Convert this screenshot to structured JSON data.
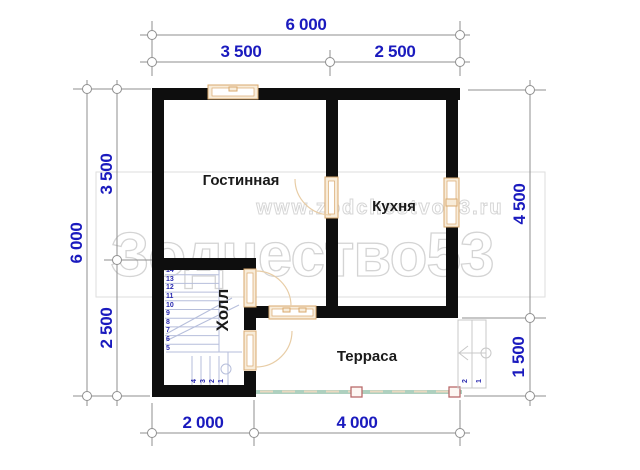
{
  "plan": {
    "watermark": {
      "site": "www.zodchestvo53.ru",
      "brand": "Зодчество53"
    },
    "rooms": {
      "living_room": "Гостинная",
      "kitchen": "Кухня",
      "hall": "Холл",
      "terrace": "Терраса"
    },
    "dims": {
      "top_total": "6 000",
      "top_left": "3 500",
      "top_right": "2 500",
      "left_total": "6 000",
      "left_top": "3 500",
      "left_bottom": "2 500",
      "right_top": "4 500",
      "right_bottom": "1 500",
      "bottom_left": "2 000",
      "bottom_right": "4 000"
    },
    "stairs": {
      "upper": [
        "14",
        "13",
        "12",
        "11",
        "10",
        "9",
        "8",
        "7",
        "6",
        "5"
      ],
      "lower": [
        "4",
        "3",
        "2",
        "1"
      ]
    },
    "terrace_steps": [
      "2",
      "1"
    ],
    "colors": {
      "dimension_text": "#1a1abe",
      "dimension_line": "#8f8f8f",
      "wall": "#0e0e0e",
      "joinery_frame": "#d9a96e",
      "joinery_fill": "#f8ecd9",
      "door_arc": "#e8cda6",
      "deck_edge": "#aed0bf",
      "deck_post": "#b96a6a",
      "stair_line": "#b6bedb",
      "stair_number": "#2a2ab0",
      "watermark": "#d6d6d6",
      "room_label": "#1a1a1a"
    }
  }
}
